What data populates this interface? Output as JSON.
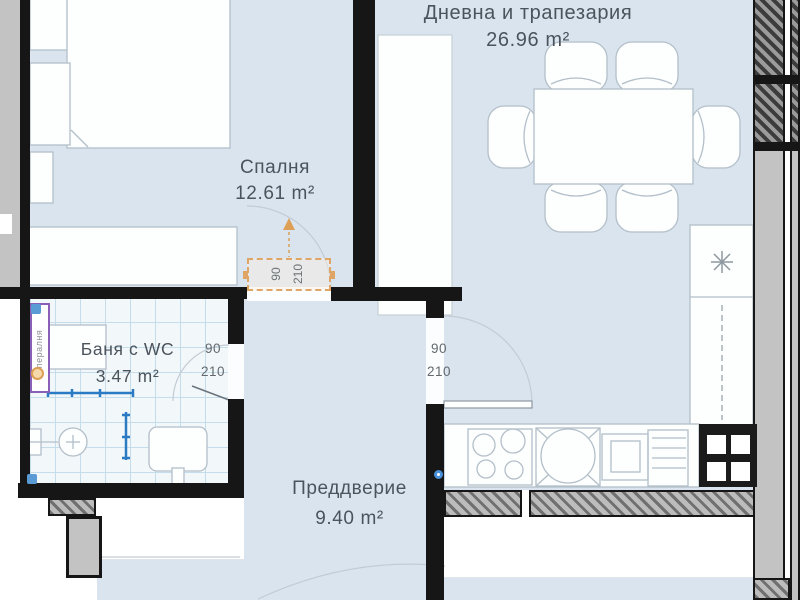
{
  "plan": {
    "title": "apartment floor plan",
    "rooms": {
      "living": {
        "name": "Дневна и трапезария",
        "area": "26.96 m²"
      },
      "bedroom": {
        "name": "Спалня",
        "area": "12.61 m²"
      },
      "bathroom": {
        "name": "Баня с WC",
        "area": "3.47 m²"
      },
      "hallway": {
        "name": "Преддверие",
        "area": "9.40 m²"
      }
    },
    "doors": {
      "bedroom": {
        "width": "90",
        "height": "210"
      },
      "bathroom": {
        "width": "90",
        "height": "210"
      },
      "living": {
        "width": "90",
        "height": "210"
      }
    },
    "shaft_label": "пералня",
    "colors": {
      "floor": "#d9e4ee",
      "wall": "#161616",
      "wall_gray": "#c3c3c3",
      "door_accent": "#dfa567",
      "plumbing_blue": "#2b7bc4",
      "tile_line": "#c5ddea",
      "furniture_line": "#b3bfc9",
      "shaft_border": "#8a5fb8",
      "label_text": "#4b545c"
    }
  }
}
